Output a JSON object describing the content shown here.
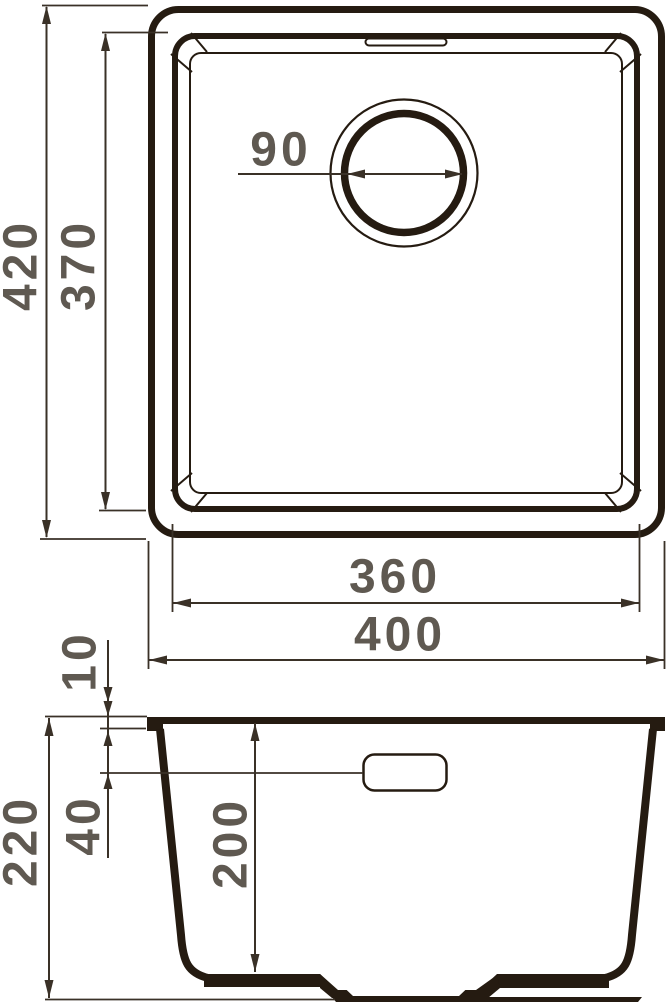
{
  "colors": {
    "background": "#ffffff",
    "outline": "#251b11",
    "dimension": "#3a3127",
    "label": "#5f5951"
  },
  "views": {
    "top": {
      "name": "sink-top-view",
      "dimensions": {
        "overall_depth": "420",
        "bowl_depth": "370",
        "drain_diameter": "90",
        "bowl_width": "360",
        "overall_width": "400"
      }
    },
    "side": {
      "name": "sink-side-section-view",
      "dimensions": {
        "rim_thickness": "10",
        "overflow_offset": "40",
        "overall_height": "220",
        "bowl_depth": "200"
      }
    }
  }
}
